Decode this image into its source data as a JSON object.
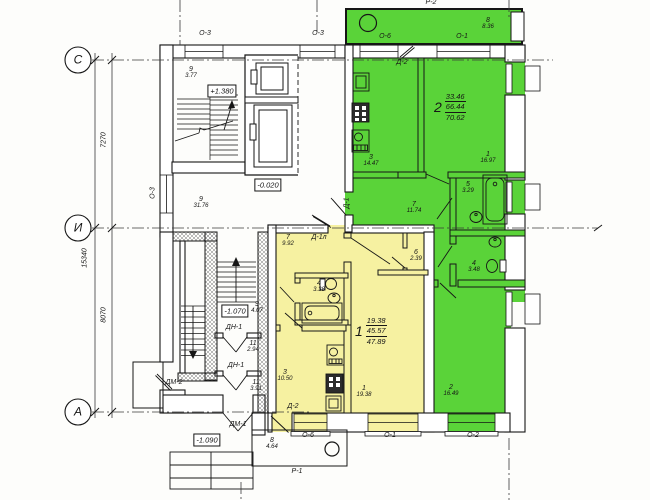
{
  "colors": {
    "apartment1_fill": "#f6f1a1",
    "apartment2_fill": "#5ad339",
    "line": "#161616",
    "background": "#fdfdfb"
  },
  "axes": {
    "c": "С",
    "i": "И",
    "a": "А"
  },
  "dims": {
    "c_to_i": "7270",
    "i_to_a": "8070",
    "total": "15340"
  },
  "levels": {
    "upper": "+1.380",
    "lobby": "-0.020",
    "lower": "-1.070",
    "entry": "-1.090"
  },
  "apt1": {
    "num": "1",
    "living": "19.38",
    "usable": "45.57",
    "total": "47.89"
  },
  "apt2": {
    "num": "2",
    "living": "33.46",
    "usable": "66.44",
    "total": "70.62"
  },
  "rooms": {
    "stair_upper": {
      "num": "9",
      "area": "3.77"
    },
    "lobby": {
      "num": "9",
      "area": "31.76"
    },
    "stair_lower": {
      "num": "9",
      "area": "4.07"
    },
    "vestibule_a": {
      "num": "11",
      "area": "2.94"
    },
    "vestibule_b": {
      "num": "11",
      "area": "3.91"
    },
    "porch": {
      "num": "8",
      "area": "4.64"
    },
    "apt2_balcony": {
      "num": "8",
      "area": "8.36"
    },
    "apt2_kitchen": {
      "num": "3",
      "area": "14.47"
    },
    "apt2_living": {
      "num": "1",
      "area": "16.97"
    },
    "apt2_bath": {
      "num": "5",
      "area": "3.29"
    },
    "apt2_hall": {
      "num": "7",
      "area": "11.74"
    },
    "apt2_wc": {
      "num": "4",
      "area": "3.48"
    },
    "apt2_bedroom": {
      "num": "2",
      "area": "16.49"
    },
    "apt1_hall": {
      "num": "7",
      "area": "9.92"
    },
    "apt1_bath": {
      "num": "4",
      "area": "3.38"
    },
    "apt1_storage": {
      "num": "6",
      "area": "2.39"
    },
    "apt1_kitchen": {
      "num": "3",
      "area": "10.50"
    },
    "apt1_living": {
      "num": "1",
      "area": "19.38"
    }
  },
  "marks": {
    "o3": "О-3",
    "o6": "О-6",
    "o1": "О-1",
    "o2": "О-2",
    "r2": "Р-2",
    "r1": "Р-1",
    "d2": "Д-2",
    "d1": "Д-1",
    "d1l": "Д-1л",
    "dn1": "ДН-1",
    "dm1": "ДМ-1",
    "dm2": "ДМ-2"
  }
}
